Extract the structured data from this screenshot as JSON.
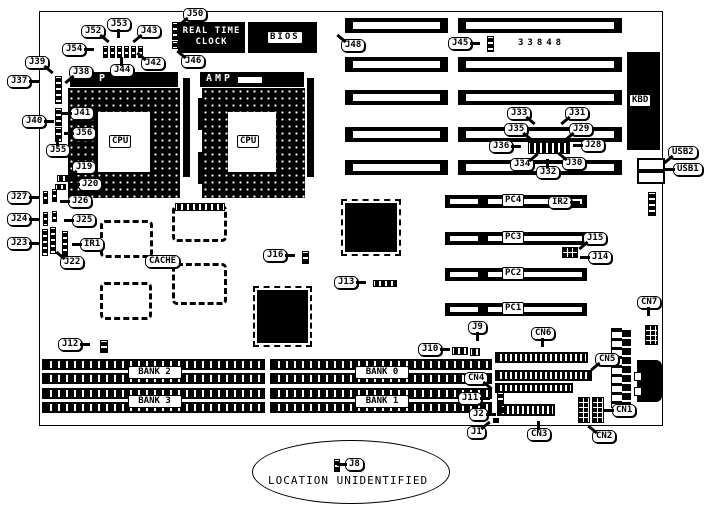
{
  "diagram": {
    "type": "motherboard-layout",
    "part_number": "33848",
    "footnote": "LOCATION UNIDENTIFIED"
  },
  "blocks": {
    "rtc_line1": "REAL TIME",
    "rtc_line2": "CLOCK",
    "bios": "BIOS",
    "kbd": "KBD",
    "cpu": "CPU",
    "amp": "AMP",
    "amp_left_visible": "P"
  },
  "callouts": [
    {
      "text": "J50",
      "x": 183,
      "y": 8,
      "tail": "dl"
    },
    {
      "text": "J53",
      "x": 107,
      "y": 18,
      "tail": "d"
    },
    {
      "text": "J52",
      "x": 81,
      "y": 25,
      "tail": "dr"
    },
    {
      "text": "J43",
      "x": 137,
      "y": 25,
      "tail": "dl"
    },
    {
      "text": "J54",
      "x": 62,
      "y": 43,
      "tail": "r"
    },
    {
      "text": "J46",
      "x": 181,
      "y": 55,
      "tail": "ul"
    },
    {
      "text": "J42",
      "x": 141,
      "y": 57,
      "tail": "ul"
    },
    {
      "text": "J39",
      "x": 25,
      "y": 56,
      "tail": "dr"
    },
    {
      "text": "J44",
      "x": 110,
      "y": 64,
      "tail": "u"
    },
    {
      "text": "J38",
      "x": 69,
      "y": 66,
      "tail": "dl"
    },
    {
      "text": "J37",
      "x": 7,
      "y": 75,
      "tail": "r"
    },
    {
      "text": "J48",
      "x": 341,
      "y": 39,
      "tail": "ul"
    },
    {
      "text": "J45",
      "x": 448,
      "y": 37,
      "tail": "r"
    },
    {
      "text": "J40",
      "x": 22,
      "y": 115,
      "tail": "r"
    },
    {
      "text": "J41",
      "x": 70,
      "y": 107,
      "tail": "l"
    },
    {
      "text": "J56",
      "x": 72,
      "y": 127,
      "tail": "l"
    },
    {
      "text": "J55",
      "x": 46,
      "y": 144,
      "tail": "u"
    },
    {
      "text": "J19",
      "x": 72,
      "y": 161,
      "tail": "dl"
    },
    {
      "text": "J20",
      "x": 78,
      "y": 178,
      "tail": "l"
    },
    {
      "text": "J27",
      "x": 7,
      "y": 191,
      "tail": "r"
    },
    {
      "text": "J26",
      "x": 68,
      "y": 195,
      "tail": "l"
    },
    {
      "text": "J24",
      "x": 7,
      "y": 213,
      "tail": "r"
    },
    {
      "text": "J25",
      "x": 72,
      "y": 214,
      "tail": "l"
    },
    {
      "text": "J23",
      "x": 7,
      "y": 237,
      "tail": "r"
    },
    {
      "text": "IR1",
      "x": 80,
      "y": 238,
      "tail": "l"
    },
    {
      "text": "J22",
      "x": 60,
      "y": 256,
      "tail": "ul"
    },
    {
      "text": "CACHE",
      "x": 145,
      "y": 255,
      "tail": "none"
    },
    {
      "text": "J33",
      "x": 507,
      "y": 107,
      "tail": "dr"
    },
    {
      "text": "J31",
      "x": 565,
      "y": 107,
      "tail": "dl"
    },
    {
      "text": "J35",
      "x": 504,
      "y": 123,
      "tail": "dr"
    },
    {
      "text": "J29",
      "x": 569,
      "y": 123,
      "tail": "dl"
    },
    {
      "text": "J36",
      "x": 489,
      "y": 140,
      "tail": "r"
    },
    {
      "text": "J28",
      "x": 581,
      "y": 139,
      "tail": "l"
    },
    {
      "text": "J34",
      "x": 510,
      "y": 158,
      "tail": "ur"
    },
    {
      "text": "J32",
      "x": 536,
      "y": 166,
      "tail": "u"
    },
    {
      "text": "J30",
      "x": 562,
      "y": 157,
      "tail": "ul"
    },
    {
      "text": "USB2",
      "x": 668,
      "y": 146,
      "tail": "dl"
    },
    {
      "text": "USB1",
      "x": 673,
      "y": 163,
      "tail": "l"
    },
    {
      "text": "IR2",
      "x": 548,
      "y": 196,
      "tail": "r"
    },
    {
      "text": "J15",
      "x": 583,
      "y": 232,
      "tail": "dl"
    },
    {
      "text": "J14",
      "x": 588,
      "y": 251,
      "tail": "l"
    },
    {
      "text": "CN7",
      "x": 637,
      "y": 296,
      "tail": "d"
    },
    {
      "text": "J16",
      "x": 263,
      "y": 249,
      "tail": "r"
    },
    {
      "text": "J13",
      "x": 334,
      "y": 276,
      "tail": "r"
    },
    {
      "text": "J12",
      "x": 58,
      "y": 338,
      "tail": "r"
    },
    {
      "text": "J9",
      "x": 468,
      "y": 321,
      "tail": "d"
    },
    {
      "text": "J10",
      "x": 418,
      "y": 343,
      "tail": "r"
    },
    {
      "text": "CN6",
      "x": 531,
      "y": 327,
      "tail": "d"
    },
    {
      "text": "CN5",
      "x": 595,
      "y": 353,
      "tail": "dl"
    },
    {
      "text": "CN4",
      "x": 464,
      "y": 372,
      "tail": "dr"
    },
    {
      "text": "J11",
      "x": 458,
      "y": 392,
      "tail": "r"
    },
    {
      "text": "J2",
      "x": 469,
      "y": 408,
      "tail": "r"
    },
    {
      "text": "J1",
      "x": 467,
      "y": 426,
      "tail": "ur"
    },
    {
      "text": "CN3",
      "x": 527,
      "y": 428,
      "tail": "u"
    },
    {
      "text": "CN2",
      "x": 592,
      "y": 430,
      "tail": "ul"
    },
    {
      "text": "CN1",
      "x": 612,
      "y": 404,
      "tail": "l"
    },
    {
      "text": "J8",
      "x": 345,
      "y": 458,
      "tail": "l"
    }
  ],
  "isa_slots": [
    {
      "x": 345,
      "y": 18,
      "w": 103
    },
    {
      "x": 458,
      "y": 18,
      "w": 164
    },
    {
      "x": 345,
      "y": 57,
      "w": 103
    },
    {
      "x": 458,
      "y": 57,
      "w": 164
    },
    {
      "x": 345,
      "y": 90,
      "w": 103
    },
    {
      "x": 458,
      "y": 90,
      "w": 164
    },
    {
      "x": 345,
      "y": 127,
      "w": 103
    },
    {
      "x": 458,
      "y": 127,
      "w": 164
    },
    {
      "x": 345,
      "y": 160,
      "w": 103
    },
    {
      "x": 458,
      "y": 160,
      "w": 164
    }
  ],
  "pci_slots": [
    {
      "label": "PC4",
      "x": 445,
      "y": 195,
      "w": 142
    },
    {
      "label": "PC3",
      "x": 445,
      "y": 232,
      "w": 142
    },
    {
      "label": "PC2",
      "x": 445,
      "y": 268,
      "w": 142
    },
    {
      "label": "PC1",
      "x": 445,
      "y": 303,
      "w": 142
    }
  ],
  "memory_banks": [
    {
      "label": "BANK 2",
      "x": 42,
      "y": 359,
      "w": 223
    },
    {
      "label": "BANK 3",
      "x": 42,
      "y": 388,
      "w": 223
    },
    {
      "label": "BANK 0",
      "x": 270,
      "y": 359,
      "w": 222
    },
    {
      "label": "BANK 1",
      "x": 270,
      "y": 388,
      "w": 222
    }
  ],
  "chips": [
    {
      "kind": "outline",
      "x": 100,
      "y": 220,
      "w": 53,
      "h": 38
    },
    {
      "kind": "outline",
      "x": 172,
      "y": 205,
      "w": 55,
      "h": 37
    },
    {
      "kind": "outline",
      "x": 172,
      "y": 263,
      "w": 55,
      "h": 42
    },
    {
      "kind": "outline",
      "x": 100,
      "y": 282,
      "w": 52,
      "h": 38
    },
    {
      "kind": "solid",
      "x": 345,
      "y": 203,
      "w": 52,
      "h": 49
    },
    {
      "kind": "solid",
      "x": 257,
      "y": 290,
      "w": 51,
      "h": 53
    }
  ],
  "components": [
    {
      "name": "rtc-jumper-j50",
      "x": 172,
      "y": 22,
      "w": 6,
      "h": 18,
      "pat": "vstrip"
    },
    {
      "name": "rtc-jumper-j46",
      "x": 172,
      "y": 41,
      "w": 6,
      "h": 8,
      "pat": "vstrip"
    },
    {
      "name": "jumper-row-1",
      "x": 103,
      "y": 46,
      "w": 5,
      "h": 12,
      "pat": "vstrip"
    },
    {
      "name": "jumper-row-2",
      "x": 110,
      "y": 46,
      "w": 5,
      "h": 12,
      "pat": "vstrip"
    },
    {
      "name": "jumper-row-3",
      "x": 117,
      "y": 46,
      "w": 5,
      "h": 12,
      "pat": "vstrip"
    },
    {
      "name": "jumper-row-4",
      "x": 124,
      "y": 46,
      "w": 5,
      "h": 12,
      "pat": "vstrip"
    },
    {
      "name": "jumper-row-5",
      "x": 131,
      "y": 46,
      "w": 5,
      "h": 12,
      "pat": "vstrip"
    },
    {
      "name": "jumper-row-6",
      "x": 138,
      "y": 46,
      "w": 5,
      "h": 12,
      "pat": "vstrip"
    },
    {
      "name": "jumper-j37-j38",
      "x": 55,
      "y": 76,
      "w": 7,
      "h": 28,
      "pat": "vstrip"
    },
    {
      "name": "jumper-j40-j41",
      "x": 55,
      "y": 108,
      "w": 7,
      "h": 18,
      "pat": "vstrip"
    },
    {
      "name": "jumper-j55-j56",
      "x": 55,
      "y": 127,
      "w": 7,
      "h": 15,
      "pat": "vstrip"
    },
    {
      "name": "jumper-j19",
      "x": 57,
      "y": 175,
      "w": 13,
      "h": 7,
      "pat": "hstrip"
    },
    {
      "name": "jumper-j20",
      "x": 55,
      "y": 184,
      "w": 11,
      "h": 6,
      "pat": "hstrip"
    },
    {
      "name": "jumper-j27",
      "x": 43,
      "y": 191,
      "w": 5,
      "h": 13,
      "pat": "vstrip"
    },
    {
      "name": "jumper-j26",
      "x": 52,
      "y": 189,
      "w": 5,
      "h": 13,
      "pat": "vstrip"
    },
    {
      "name": "jumper-j24",
      "x": 43,
      "y": 212,
      "w": 5,
      "h": 14,
      "pat": "vstrip"
    },
    {
      "name": "jumper-j25",
      "x": 52,
      "y": 211,
      "w": 5,
      "h": 11,
      "pat": "vstrip"
    },
    {
      "name": "jumper-j23",
      "x": 42,
      "y": 229,
      "w": 6,
      "h": 27,
      "pat": "vstrip"
    },
    {
      "name": "jumper-j22",
      "x": 50,
      "y": 227,
      "w": 6,
      "h": 27,
      "pat": "vstrip"
    },
    {
      "name": "jumper-ir1",
      "x": 62,
      "y": 231,
      "w": 6,
      "h": 25,
      "pat": "vstrip"
    },
    {
      "name": "jumper-j45",
      "x": 487,
      "y": 36,
      "w": 7,
      "h": 16,
      "pat": "vstrip"
    },
    {
      "name": "jumper-cluster-j28-j36",
      "x": 528,
      "y": 142,
      "w": 42,
      "h": 12,
      "pat": "hstrip"
    },
    {
      "name": "jumper-ir2",
      "x": 648,
      "y": 192,
      "w": 8,
      "h": 24,
      "pat": "vstrip"
    },
    {
      "name": "jumper-j14-j15",
      "x": 562,
      "y": 247,
      "w": 16,
      "h": 11,
      "pat": "grid"
    },
    {
      "name": "jumper-j16",
      "x": 302,
      "y": 251,
      "w": 7,
      "h": 13,
      "pat": "vstrip"
    },
    {
      "name": "jumper-j13",
      "x": 373,
      "y": 280,
      "w": 24,
      "h": 7,
      "pat": "hstrip"
    },
    {
      "name": "jumper-j12",
      "x": 100,
      "y": 340,
      "w": 8,
      "h": 13,
      "pat": "vstrip"
    },
    {
      "name": "jumper-j9",
      "x": 470,
      "y": 348,
      "w": 10,
      "h": 8,
      "pat": "hstrip"
    },
    {
      "name": "jumper-j10",
      "x": 452,
      "y": 347,
      "w": 16,
      "h": 8,
      "pat": "hstrip"
    },
    {
      "name": "connector-cn6",
      "x": 495,
      "y": 352,
      "w": 93,
      "h": 11,
      "pat": "ticks"
    },
    {
      "name": "connector-cn5",
      "x": 495,
      "y": 370,
      "w": 97,
      "h": 11,
      "pat": "ticks"
    },
    {
      "name": "connector-cn4",
      "x": 495,
      "y": 383,
      "w": 78,
      "h": 10,
      "pat": "ticks"
    },
    {
      "name": "connector-cn3",
      "x": 497,
      "y": 404,
      "w": 58,
      "h": 12,
      "pat": "ticks"
    },
    {
      "name": "jumper-j11",
      "x": 497,
      "y": 392,
      "w": 7,
      "h": 13,
      "pat": "vstrip"
    },
    {
      "name": "jumper-j2",
      "x": 499,
      "y": 407,
      "w": 6,
      "h": 6,
      "pat": "grid"
    },
    {
      "name": "jumper-j1",
      "x": 493,
      "y": 418,
      "w": 6,
      "h": 5,
      "pat": "solid"
    },
    {
      "name": "connector-cn2",
      "x": 578,
      "y": 397,
      "w": 12,
      "h": 26,
      "pat": "grid"
    },
    {
      "name": "connector-cn1",
      "x": 592,
      "y": 397,
      "w": 12,
      "h": 26,
      "pat": "grid"
    },
    {
      "name": "connector-cn7",
      "x": 645,
      "y": 325,
      "w": 13,
      "h": 20,
      "pat": "grid"
    },
    {
      "name": "jumper-j8",
      "x": 334,
      "y": 459,
      "w": 6,
      "h": 13,
      "pat": "vstrip"
    },
    {
      "name": "cpu2-left-pins-a",
      "x": 198,
      "y": 98,
      "w": 4,
      "h": 32,
      "pat": "solid"
    },
    {
      "name": "cpu2-left-pins-b",
      "x": 198,
      "y": 152,
      "w": 4,
      "h": 32,
      "pat": "solid"
    },
    {
      "name": "bar-below-cpu2",
      "x": 175,
      "y": 203,
      "w": 50,
      "h": 8,
      "pat": "hstrip"
    }
  ]
}
